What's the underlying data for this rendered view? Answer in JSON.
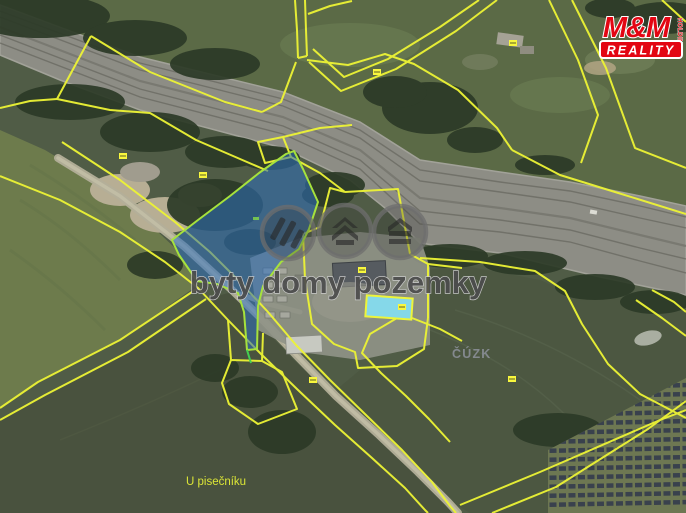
{
  "map": {
    "watermark": {
      "text": "byty domy pozemky",
      "icons": [
        "mm-stripes-icon",
        "house-roof-icon",
        "stacked-house-icon"
      ]
    },
    "labels": {
      "region_office": "ČÚZK",
      "street": "U pisečníku"
    },
    "logo": {
      "name": "M&M",
      "holding": "HOLDING",
      "reality": "REALITY",
      "red": "#e30613"
    },
    "colors": {
      "cadastral_line": "#edf435",
      "highlight_parcel_fill": "#2e6fbe",
      "highlight_parcel_border": "#a6e23c",
      "pool": "#85d8e9",
      "railway": "#8d8d85",
      "road": "#b3af99",
      "label_gray": "#878c93",
      "label_yellow": "#dbe536"
    }
  }
}
